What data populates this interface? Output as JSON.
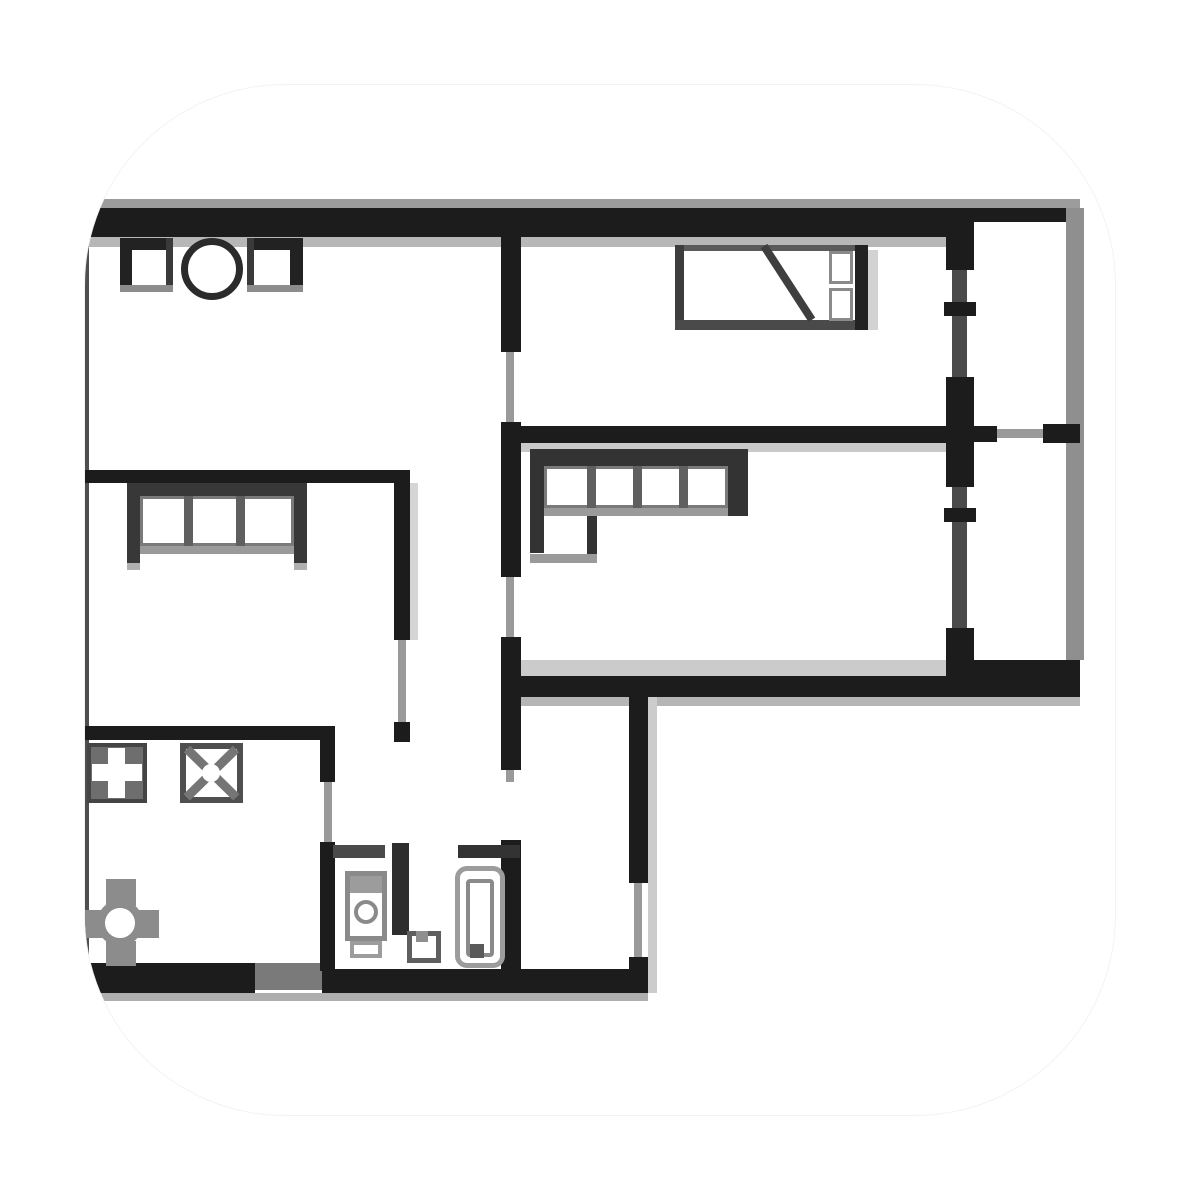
{
  "meta": {
    "image_type": "apartment-floor-plan-illustration",
    "background": "#ffffff",
    "tile_background": "#ffffff"
  },
  "palette": {
    "wall": "#1c1c1c",
    "wall_soft": "#383838",
    "opening": "#9a9a9a",
    "shadow": "#c9c9c9",
    "fixture_gray": "#8c8c8c",
    "white": "#ffffff"
  },
  "plan": {
    "elements": [
      {
        "n": "top-outer-gray-strip",
        "t": "rect",
        "x": 88,
        "y": 199,
        "w": 992,
        "h": 11,
        "f": "#9c9c9c"
      },
      {
        "n": "under-top-wall-strip",
        "t": "rect",
        "x": 88,
        "y": 237,
        "w": 862,
        "h": 10,
        "f": "#b7b7b7"
      },
      {
        "n": "under-bedroom-wall-strip",
        "t": "rect",
        "x": 513,
        "y": 443,
        "w": 439,
        "h": 9,
        "f": "#c9c9c9"
      },
      {
        "n": "living-floor-strip",
        "t": "rect",
        "x": 517,
        "y": 660,
        "w": 433,
        "h": 16,
        "f": "#cbcbcb"
      },
      {
        "n": "under-living-wall-strip",
        "t": "rect",
        "x": 513,
        "y": 697,
        "w": 567,
        "h": 9,
        "f": "#b5b5b5"
      },
      {
        "n": "hall-wall-shadow",
        "t": "rect",
        "x": 648,
        "y": 697,
        "w": 9,
        "h": 296,
        "f": "#cccccc"
      },
      {
        "n": "bed-shadow",
        "t": "rect",
        "x": 868,
        "y": 250,
        "w": 10,
        "h": 80,
        "f": "#d2d2d2"
      },
      {
        "n": "bottom-under-strip",
        "t": "rect",
        "x": 82,
        "y": 993,
        "w": 566,
        "h": 8,
        "f": "#aeaeae"
      },
      {
        "n": "leftroom-wall-shadow",
        "t": "rect",
        "x": 410,
        "y": 483,
        "w": 8,
        "h": 157,
        "f": "#d5d5d5"
      },
      {
        "n": "top-wall-main",
        "t": "rect",
        "x": 88,
        "y": 208,
        "w": 862,
        "h": 29,
        "f": "#1c1c1c"
      },
      {
        "n": "top-wall-balcony",
        "t": "rect",
        "x": 950,
        "y": 208,
        "w": 130,
        "h": 14,
        "f": "#1c1c1c"
      },
      {
        "n": "left-exterior-wall",
        "t": "rect",
        "x": 82,
        "y": 237,
        "w": 7,
        "h": 726,
        "f": "#4f4f4f"
      },
      {
        "n": "bottom-wall-left",
        "t": "rect",
        "x": 82,
        "y": 963,
        "w": 173,
        "h": 30,
        "f": "#1c1c1c"
      },
      {
        "n": "bottom-wall-entry",
        "t": "rect",
        "x": 255,
        "y": 963,
        "w": 67,
        "h": 27,
        "f": "#7a7a7a"
      },
      {
        "n": "bottom-wall-bath",
        "t": "rect",
        "x": 322,
        "y": 969,
        "w": 326,
        "h": 24,
        "f": "#1c1c1c"
      },
      {
        "n": "central-wall-upper",
        "t": "rect",
        "x": 501,
        "y": 237,
        "w": 20,
        "h": 115,
        "f": "#1c1c1c"
      },
      {
        "n": "bedroom-door-opening",
        "t": "rect",
        "x": 506,
        "y": 352,
        "w": 8,
        "h": 70,
        "f": "#9a9a9a"
      },
      {
        "n": "central-wall-mid",
        "t": "rect",
        "x": 501,
        "y": 422,
        "w": 20,
        "h": 155,
        "f": "#1c1c1c"
      },
      {
        "n": "living-door-opening",
        "t": "rect",
        "x": 506,
        "y": 577,
        "w": 8,
        "h": 60,
        "f": "#9a9a9a"
      },
      {
        "n": "central-wall-lower",
        "t": "rect",
        "x": 501,
        "y": 637,
        "w": 20,
        "h": 133,
        "f": "#1c1c1c"
      },
      {
        "n": "central-wall-stub",
        "t": "rect",
        "x": 506,
        "y": 770,
        "w": 8,
        "h": 12,
        "f": "#9a9a9a"
      },
      {
        "n": "bath-right-wall",
        "t": "rect",
        "x": 501,
        "y": 840,
        "w": 20,
        "h": 131,
        "f": "#1c1c1c"
      },
      {
        "n": "bedroom-living-wall",
        "t": "rect",
        "x": 513,
        "y": 426,
        "w": 439,
        "h": 17,
        "f": "#1c1c1c"
      },
      {
        "n": "living-bottom-wall",
        "t": "rect",
        "x": 513,
        "y": 676,
        "w": 439,
        "h": 21,
        "f": "#1c1c1c"
      },
      {
        "n": "balcony-window-line",
        "t": "rect",
        "x": 952,
        "y": 222,
        "w": 15,
        "h": 475,
        "f": "#4a4a4a"
      },
      {
        "n": "balcony-pier-top",
        "t": "rect",
        "x": 946,
        "y": 222,
        "w": 28,
        "h": 48,
        "f": "#1c1c1c"
      },
      {
        "n": "balcony-pier-mid",
        "t": "rect",
        "x": 946,
        "y": 377,
        "w": 28,
        "h": 110,
        "f": "#1c1c1c"
      },
      {
        "n": "balcony-pier-bottom",
        "t": "rect",
        "x": 946,
        "y": 628,
        "w": 28,
        "h": 69,
        "f": "#1c1c1c"
      },
      {
        "n": "balcony-window-tick-1",
        "t": "rect",
        "x": 944,
        "y": 302,
        "w": 32,
        "h": 14,
        "f": "#1c1c1c"
      },
      {
        "n": "balcony-window-tick-2",
        "t": "rect",
        "x": 944,
        "y": 508,
        "w": 32,
        "h": 14,
        "f": "#1c1c1c"
      },
      {
        "n": "balcony-bottom-wall",
        "t": "rect",
        "x": 950,
        "y": 660,
        "w": 130,
        "h": 37,
        "f": "#1c1c1c"
      },
      {
        "n": "balcony-right-edge",
        "t": "rect",
        "x": 1066,
        "y": 208,
        "w": 18,
        "h": 452,
        "f": "#8f8f8f"
      },
      {
        "n": "balcony-door-seg-a",
        "t": "rect",
        "x": 974,
        "y": 426,
        "w": 23,
        "h": 16,
        "f": "#1c1c1c"
      },
      {
        "n": "balcony-door-line",
        "t": "rect",
        "x": 997,
        "y": 429,
        "w": 46,
        "h": 9,
        "f": "#9a9a9a"
      },
      {
        "n": "balcony-door-seg-b",
        "t": "rect",
        "x": 1043,
        "y": 424,
        "w": 37,
        "h": 19,
        "f": "#1c1c1c"
      },
      {
        "n": "leftroom-top-wall",
        "t": "rect",
        "x": 82,
        "y": 470,
        "w": 328,
        "h": 13,
        "f": "#1c1c1c"
      },
      {
        "n": "leftroom-right-wall",
        "t": "rect",
        "x": 394,
        "y": 470,
        "w": 16,
        "h": 170,
        "f": "#1c1c1c"
      },
      {
        "n": "leftroom-door-opening",
        "t": "rect",
        "x": 398,
        "y": 640,
        "w": 8,
        "h": 82,
        "f": "#9a9a9a"
      },
      {
        "n": "leftroom-right-wall-b",
        "t": "rect",
        "x": 394,
        "y": 722,
        "w": 16,
        "h": 20,
        "f": "#1c1c1c"
      },
      {
        "n": "mid-horizontal-wall",
        "t": "rect",
        "x": 82,
        "y": 726,
        "w": 253,
        "h": 14,
        "f": "#1c1c1c"
      },
      {
        "n": "kitchen-right-wall",
        "t": "rect",
        "x": 320,
        "y": 740,
        "w": 15,
        "h": 42,
        "f": "#1c1c1c"
      },
      {
        "n": "kitchen-door-opening",
        "t": "rect",
        "x": 324,
        "y": 782,
        "w": 8,
        "h": 60,
        "f": "#9a9a9a"
      },
      {
        "n": "bath-left-wall",
        "t": "rect",
        "x": 320,
        "y": 842,
        "w": 15,
        "h": 129,
        "f": "#1c1c1c"
      },
      {
        "n": "bath-top-wall-a",
        "t": "rect",
        "x": 333,
        "y": 845,
        "w": 52,
        "h": 13,
        "f": "#4a4a4a"
      },
      {
        "n": "bath-divider-wall",
        "t": "rect",
        "x": 392,
        "y": 843,
        "w": 17,
        "h": 92,
        "f": "#2e2e2e"
      },
      {
        "n": "bath-top-wall-b",
        "t": "rect",
        "x": 458,
        "y": 845,
        "w": 62,
        "h": 13,
        "f": "#333333"
      },
      {
        "n": "hall-right-wall-a",
        "t": "rect",
        "x": 629,
        "y": 697,
        "w": 19,
        "h": 186,
        "f": "#1c1c1c"
      },
      {
        "n": "hall-right-window",
        "t": "rect",
        "x": 634,
        "y": 883,
        "w": 8,
        "h": 74,
        "f": "#9a9a9a"
      },
      {
        "n": "hall-right-wall-b",
        "t": "rect",
        "x": 629,
        "y": 957,
        "w": 19,
        "h": 36,
        "f": "#1c1c1c"
      },
      {
        "n": "counter-square-1-top",
        "t": "rect",
        "x": 120,
        "y": 238,
        "w": 53,
        "h": 12,
        "f": "#222222"
      },
      {
        "n": "counter-square-1-left",
        "t": "rect",
        "x": 120,
        "y": 238,
        "w": 12,
        "h": 54,
        "f": "#222222"
      },
      {
        "n": "counter-square-1-right",
        "t": "rect",
        "x": 166,
        "y": 238,
        "w": 7,
        "h": 54,
        "f": "#3a3a3a"
      },
      {
        "n": "counter-square-1-bottom",
        "t": "rect",
        "x": 120,
        "y": 285,
        "w": 53,
        "h": 7,
        "f": "#8c8c8c"
      },
      {
        "n": "stove-circle",
        "t": "circle",
        "cx": 212,
        "cy": 269,
        "rad": 31,
        "ring": "7px solid #2b2b2b",
        "f": "#ffffff"
      },
      {
        "n": "counter-square-2-top",
        "t": "rect",
        "x": 247,
        "y": 238,
        "w": 56,
        "h": 12,
        "f": "#222222"
      },
      {
        "n": "counter-square-2-left",
        "t": "rect",
        "x": 247,
        "y": 238,
        "w": 7,
        "h": 54,
        "f": "#3a3a3a"
      },
      {
        "n": "counter-square-2-right",
        "t": "rect",
        "x": 290,
        "y": 238,
        "w": 13,
        "h": 54,
        "f": "#222222"
      },
      {
        "n": "counter-square-2-bottom",
        "t": "rect",
        "x": 247,
        "y": 285,
        "w": 56,
        "h": 7,
        "f": "#8c8c8c"
      },
      {
        "n": "sofa-left-back",
        "t": "rect",
        "x": 127,
        "y": 483,
        "w": 180,
        "h": 13,
        "f": "#383838"
      },
      {
        "n": "sofa-left-arm-left",
        "t": "rect",
        "x": 127,
        "y": 483,
        "w": 13,
        "h": 80,
        "f": "#383838"
      },
      {
        "n": "sofa-left-arm-right",
        "t": "rect",
        "x": 294,
        "y": 483,
        "w": 13,
        "h": 80,
        "f": "#383838"
      },
      {
        "n": "sofa-left-seat",
        "t": "rect",
        "x": 140,
        "y": 496,
        "w": 154,
        "h": 50,
        "f": "#ffffff",
        "b": "3px solid #7a7a7a"
      },
      {
        "n": "sofa-left-divider-1",
        "t": "rect",
        "x": 184,
        "y": 496,
        "w": 9,
        "h": 50,
        "f": "#5f5f5f"
      },
      {
        "n": "sofa-left-divider-2",
        "t": "rect",
        "x": 236,
        "y": 496,
        "w": 9,
        "h": 50,
        "f": "#5f5f5f"
      },
      {
        "n": "sofa-left-front-edge",
        "t": "rect",
        "x": 140,
        "y": 546,
        "w": 154,
        "h": 8,
        "f": "#9a9a9a"
      },
      {
        "n": "sofa-left-foot-left",
        "t": "rect",
        "x": 127,
        "y": 563,
        "w": 13,
        "h": 7,
        "f": "#b0b0b0"
      },
      {
        "n": "sofa-left-foot-right",
        "t": "rect",
        "x": 294,
        "y": 563,
        "w": 13,
        "h": 7,
        "f": "#b0b0b0"
      },
      {
        "n": "bed-frame-top",
        "t": "rect",
        "x": 675,
        "y": 245,
        "w": 193,
        "h": 6,
        "f": "#5a5a5a"
      },
      {
        "n": "bed-frame-left",
        "t": "rect",
        "x": 675,
        "y": 245,
        "w": 9,
        "h": 85,
        "f": "#3d3d3d"
      },
      {
        "n": "bed-frame-bottom",
        "t": "rect",
        "x": 675,
        "y": 320,
        "w": 193,
        "h": 10,
        "f": "#4a4a4a"
      },
      {
        "n": "bed-frame-right",
        "t": "rect",
        "x": 855,
        "y": 245,
        "w": 13,
        "h": 85,
        "f": "#222222"
      },
      {
        "n": "bed-blanket-diagonal",
        "t": "line",
        "x1": 764,
        "y1": 246,
        "x2": 812,
        "y2": 320,
        "w": 8,
        "f": "#3f3f3f"
      },
      {
        "n": "bed-pillow-1",
        "t": "rect",
        "x": 829,
        "y": 251,
        "w": 24,
        "h": 33,
        "f": "#ffffff",
        "b": "3px solid #8a8a8a"
      },
      {
        "n": "bed-pillow-2",
        "t": "rect",
        "x": 829,
        "y": 288,
        "w": 24,
        "h": 33,
        "f": "#ffffff",
        "b": "3px solid #8a8a8a"
      },
      {
        "n": "sofa-living-back",
        "t": "rect",
        "x": 530,
        "y": 449,
        "w": 215,
        "h": 17,
        "f": "#333333"
      },
      {
        "n": "sofa-living-left-edge",
        "t": "rect",
        "x": 530,
        "y": 449,
        "w": 14,
        "h": 104,
        "f": "#333333"
      },
      {
        "n": "sofa-living-arm-right",
        "t": "rect",
        "x": 728,
        "y": 449,
        "w": 20,
        "h": 67,
        "f": "#333333"
      },
      {
        "n": "sofa-living-seat",
        "t": "rect",
        "x": 544,
        "y": 466,
        "w": 184,
        "h": 42,
        "f": "#ffffff",
        "b": "3px solid #7a7a7a"
      },
      {
        "n": "sofa-living-divider-1",
        "t": "rect",
        "x": 587,
        "y": 466,
        "w": 9,
        "h": 42,
        "f": "#5f5f5f"
      },
      {
        "n": "sofa-living-divider-2",
        "t": "rect",
        "x": 633,
        "y": 466,
        "w": 9,
        "h": 42,
        "f": "#5f5f5f"
      },
      {
        "n": "sofa-living-divider-3",
        "t": "rect",
        "x": 679,
        "y": 466,
        "w": 9,
        "h": 42,
        "f": "#5f5f5f"
      },
      {
        "n": "sofa-living-front-edge",
        "t": "rect",
        "x": 544,
        "y": 508,
        "w": 184,
        "h": 8,
        "f": "#9a9a9a"
      },
      {
        "n": "sofa-living-return-edge",
        "t": "rect",
        "x": 587,
        "y": 516,
        "w": 10,
        "h": 38,
        "f": "#333333"
      },
      {
        "n": "sofa-living-return-bottom",
        "t": "rect",
        "x": 530,
        "y": 554,
        "w": 67,
        "h": 9,
        "f": "#9a9a9a"
      },
      {
        "n": "kitchen-sink-bg",
        "t": "rect",
        "x": 87,
        "y": 743,
        "w": 60,
        "h": 60,
        "f": "#6e6e6e"
      },
      {
        "n": "kitchen-sink-cross-v",
        "t": "rect",
        "x": 108,
        "y": 748,
        "w": 17,
        "h": 50,
        "f": "#ffffff"
      },
      {
        "n": "kitchen-sink-cross-h",
        "t": "rect",
        "x": 92,
        "y": 764,
        "w": 50,
        "h": 17,
        "f": "#ffffff"
      },
      {
        "n": "kitchen-sink-frame",
        "t": "rect",
        "x": 87,
        "y": 743,
        "w": 60,
        "h": 60,
        "b": "4px solid #454545"
      },
      {
        "n": "kitchen-hob-box",
        "t": "rect",
        "x": 180,
        "y": 743,
        "w": 63,
        "h": 60,
        "f": "#ffffff",
        "b": "6px solid #4f4f4f"
      },
      {
        "n": "kitchen-hob-diag-a",
        "t": "line",
        "x1": 187,
        "y1": 749,
        "x2": 236,
        "y2": 797,
        "w": 9,
        "f": "#757575"
      },
      {
        "n": "kitchen-hob-diag-b",
        "t": "line",
        "x1": 236,
        "y1": 749,
        "x2": 187,
        "y2": 797,
        "w": 9,
        "f": "#757575"
      },
      {
        "n": "kitchen-hob-center",
        "t": "circle",
        "cx": 211,
        "cy": 773,
        "rad": 9,
        "f": "#ffffff"
      },
      {
        "n": "table-chair-top",
        "t": "rect",
        "x": 106,
        "y": 879,
        "w": 30,
        "h": 27,
        "f": "#8c8c8c"
      },
      {
        "n": "table-chair-bottom",
        "t": "rect",
        "x": 106,
        "y": 941,
        "w": 30,
        "h": 25,
        "f": "#8c8c8c"
      },
      {
        "n": "table-chair-left",
        "t": "rect",
        "x": 83,
        "y": 910,
        "w": 24,
        "h": 28,
        "f": "#8c8c8c"
      },
      {
        "n": "table-chair-right",
        "t": "rect",
        "x": 135,
        "y": 910,
        "w": 24,
        "h": 28,
        "f": "#8c8c8c"
      },
      {
        "n": "round-table",
        "t": "circle",
        "cx": 120,
        "cy": 923,
        "rad": 23,
        "ring": "8px solid #8c8c8c",
        "f": "#ffffff"
      },
      {
        "n": "washer-body",
        "t": "rect",
        "x": 345,
        "y": 871,
        "w": 42,
        "h": 70,
        "f": "#ffffff",
        "b": "5px solid #8a8a8a"
      },
      {
        "n": "washer-top-panel",
        "t": "rect",
        "x": 350,
        "y": 876,
        "w": 32,
        "h": 17,
        "f": "#9c9c9c"
      },
      {
        "n": "washer-drum",
        "t": "circle",
        "cx": 366,
        "cy": 912,
        "rad": 12,
        "ring": "4px solid #8a8a8a",
        "f": "#ffffff"
      },
      {
        "n": "washer-base",
        "t": "rect",
        "x": 350,
        "y": 941,
        "w": 32,
        "h": 17,
        "f": "#ffffff",
        "b": "4px solid #9c9c9c"
      },
      {
        "n": "toilet-body",
        "t": "rect",
        "x": 407,
        "y": 931,
        "w": 34,
        "h": 32,
        "f": "#ffffff",
        "b": "5px solid #5f5f5f"
      },
      {
        "n": "toilet-tank-notch",
        "t": "rect",
        "x": 416,
        "y": 931,
        "w": 12,
        "h": 11,
        "f": "#8f8f8f"
      },
      {
        "n": "bathtub-outer",
        "t": "rect",
        "x": 455,
        "y": 866,
        "w": 50,
        "h": 102,
        "f": "#ffffff",
        "b": "5px solid #9c9c9c",
        "r": 12
      },
      {
        "n": "bathtub-inner",
        "t": "rect",
        "x": 466,
        "y": 879,
        "w": 28,
        "h": 78,
        "f": "#ffffff",
        "b": "4px solid #8a8a8a",
        "r": 4
      },
      {
        "n": "bathtub-drain",
        "t": "rect",
        "x": 470,
        "y": 944,
        "w": 14,
        "h": 14,
        "f": "#5a5a5a"
      }
    ]
  }
}
